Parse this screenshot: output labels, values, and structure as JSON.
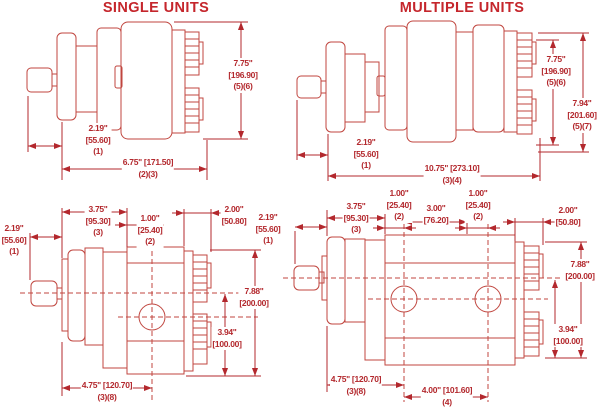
{
  "titles": {
    "single": "SINGLE UNITS",
    "multiple": "MULTIPLE UNITS"
  },
  "colors": {
    "line": "#c0463f",
    "dim_text": "#b3282d",
    "title": "#c5262c",
    "background": "#ffffff"
  },
  "views": {
    "single_side": {
      "dims": {
        "height": {
          "in": "7.75\"",
          "mm": "[196.90]",
          "note": "(5)(6)"
        },
        "shaft": {
          "in": "2.19\"",
          "mm": "[55.60]",
          "note": "(1)"
        },
        "length": {
          "in": "6.75\" [171.50]",
          "note": "(2)(3)"
        }
      }
    },
    "multiple_side": {
      "dims": {
        "height_a": {
          "in": "7.75\"",
          "mm": "[196.90]",
          "note": "(5)(6)"
        },
        "height_b": {
          "in": "7.94\"",
          "mm": "[201.60]",
          "note": "(5)(7)"
        },
        "shaft": {
          "in": "2.19\"",
          "mm": "[55.60]",
          "note": "(1)"
        },
        "length": {
          "in": "10.75\" [273.10]",
          "note": "(3)(4)"
        }
      }
    },
    "single_front": {
      "dims": {
        "shaft": {
          "in": "2.19\"",
          "mm": "[55.60]",
          "note": "(1)"
        },
        "flange_to_port": {
          "in": "3.75\"",
          "mm": "[95.30]",
          "note": "(3)"
        },
        "port_offset": {
          "in": "1.00\"",
          "mm": "[25.40]",
          "note": "(2)"
        },
        "end_width": {
          "in": "2.00\"",
          "mm": "[50.80]"
        },
        "height": {
          "in": "7.88\"",
          "mm": "[200.00]"
        },
        "half_height": {
          "in": "3.94\"",
          "mm": "[100.00]"
        },
        "mount_length": {
          "in": "4.75\" [120.70]",
          "note": "(3)(8)"
        }
      }
    },
    "multiple_front": {
      "dims": {
        "shaft": {
          "in": "2.19\"",
          "mm": "[55.60]",
          "note": "(1)"
        },
        "flange_to_port": {
          "in": "3.75\"",
          "mm": "[95.30]",
          "note": "(3)"
        },
        "port_offset_1": {
          "in": "1.00\"",
          "mm": "[25.40]",
          "note": "(2)"
        },
        "port_spacing": {
          "in": "3.00\"",
          "mm": "[76.20]"
        },
        "port_offset_2": {
          "in": "1.00\"",
          "mm": "[25.40]",
          "note": "(2)"
        },
        "end_width": {
          "in": "2.00\"",
          "mm": "[50.80]"
        },
        "height": {
          "in": "7.88\"",
          "mm": "[200.00]"
        },
        "half_height": {
          "in": "3.94\"",
          "mm": "[100.00]"
        },
        "mount_length": {
          "in": "4.75\" [120.70]",
          "note": "(3)(8)"
        },
        "section_spacing": {
          "in": "4.00\" [101.60]",
          "note": "(4)"
        }
      }
    }
  }
}
